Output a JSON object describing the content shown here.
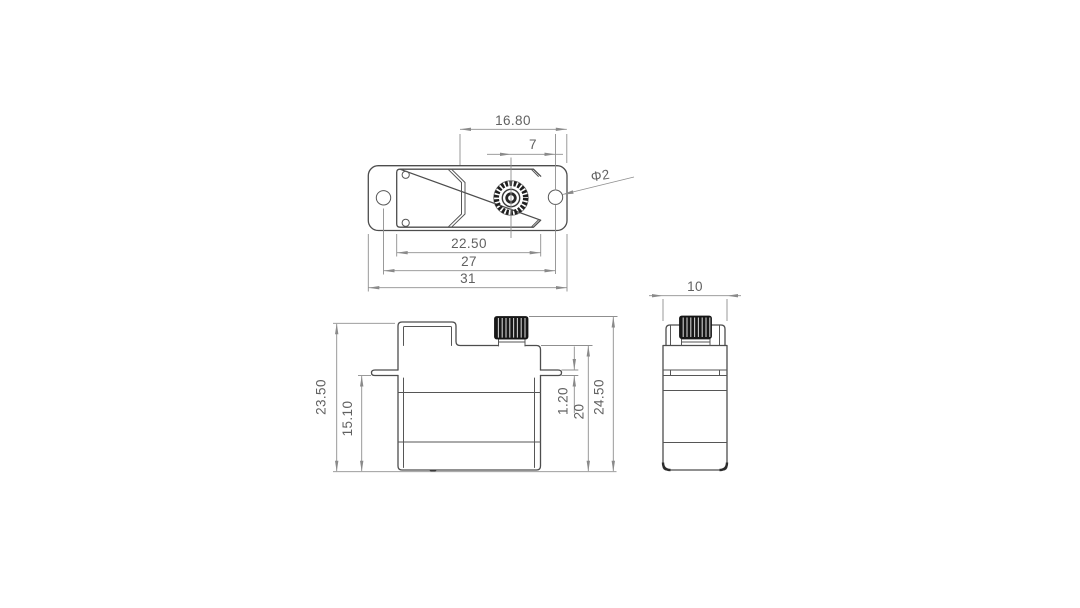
{
  "drawing": {
    "type": "technical-dimension-drawing",
    "subject": "micro servo three-view outline drawing",
    "background": "#ffffff",
    "colors": {
      "outline": "#4d4d4d",
      "dimension_lines": "#8f8f8f",
      "text": "#616161",
      "gear_fill": "#181818"
    },
    "views": {
      "top": {
        "labels": {
          "shaft_offset": "16.80",
          "shaft_to_hole": "7",
          "hole_diameter": "Φ2",
          "body_width": "22.50",
          "hole_spacing": "27",
          "overall_width": "31"
        }
      },
      "front": {
        "labels": {
          "case_height": "23.50",
          "below_flange": "15.10",
          "flange_thickness": "1.20",
          "body_upper_height": "20",
          "overall_height": "24.50"
        }
      },
      "side": {
        "labels": {
          "case_depth": "10"
        }
      }
    }
  }
}
